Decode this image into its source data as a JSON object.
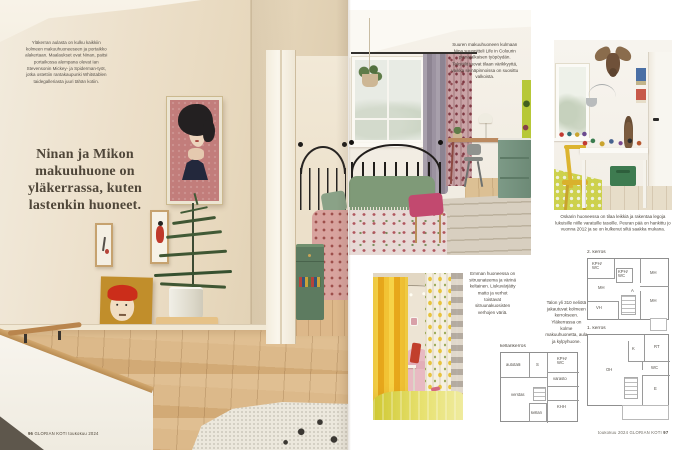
{
  "magazine": {
    "left_page": {
      "intro_caption": "Yläkerran aulasta on kulku kaikkiin kolmeen makuuhuoneeseen ja portaikko alakertaan. Maalaukset ovat Ninan, paitsi portaikossa alempana olevat Ian Stevensonin Mickey- ja Spiderman-työt, jotka ostettiin rantakaupunki Whitstablen taidegalleriasta juuri tähän kotiin.",
      "headline": "Ninan ja Mikon makuuhuone on yläkerrassa, kuten lastenkin huoneet.",
      "footer": {
        "page": "96",
        "credit": "GLORIAN KOTI toukokuu 2024"
      }
    },
    "right_page": {
      "caption_master_bedroom": "Suuren makuuhuoneen kulmaan Nina suunnitteli Life in Colourin pinnajalkaisen työpöydän. Tekstiilit tuovat tilaan värikkyyttä, vaikka seinäpinnoissa on suosittu valkoista.",
      "caption_oskari_room": "Oskarin huoneessa on tilaa leikkiä ja rakentaa legoja lukuisille niille varatuille tasoille. Peuran pää on hankittu jo vuonna 2012 ja se on kulkenut siltä saakka mukana.",
      "caption_emma_room": "Emman huoneessa on sitruunateema ja värinä keltainen. Liukuvärjätty matto ja verhot toistavat sitruunakuosisten verhojen väriä.",
      "house_facts": "Talon yli 310 neliötä jakautuvat kolmeen kerrokseen. Yläkerrassa on kolme makuuhuonetta, aula ja kylpyhuone.",
      "floorplans": {
        "floor2": {
          "label": "2. kerros",
          "rooms": [
            "KPH/\nWC",
            "KPH/\nWC",
            "MH",
            "MH",
            "A",
            "MH",
            "VH"
          ]
        },
        "floor1": {
          "label": "1. kerros",
          "rooms": [
            "K",
            "RT",
            "OH",
            "WC",
            "E"
          ]
        },
        "basement": {
          "label": "kellarikerros",
          "rooms": [
            "autotalli",
            "S",
            "KPH/\nWC",
            "verstas",
            "varasto",
            "KHH",
            "kellari"
          ]
        }
      },
      "footer": {
        "credit": "toukokuu 2024 GLORIAN KOTI",
        "page": "97"
      }
    },
    "colors": {
      "wall_cream": "#eadfcb",
      "floor_oak": "#d8b384",
      "portrait_pink": "#c27d7b",
      "painting_mustard": "#c18e2b",
      "accent_red": "#cb2d1a",
      "dresser_sage": "#74917c",
      "curtain_yellow": "#f0c125",
      "kids_rug_yellow": "#cdd14c",
      "plan_line": "#8f8f8f",
      "page_bg": "#ffffff"
    }
  }
}
